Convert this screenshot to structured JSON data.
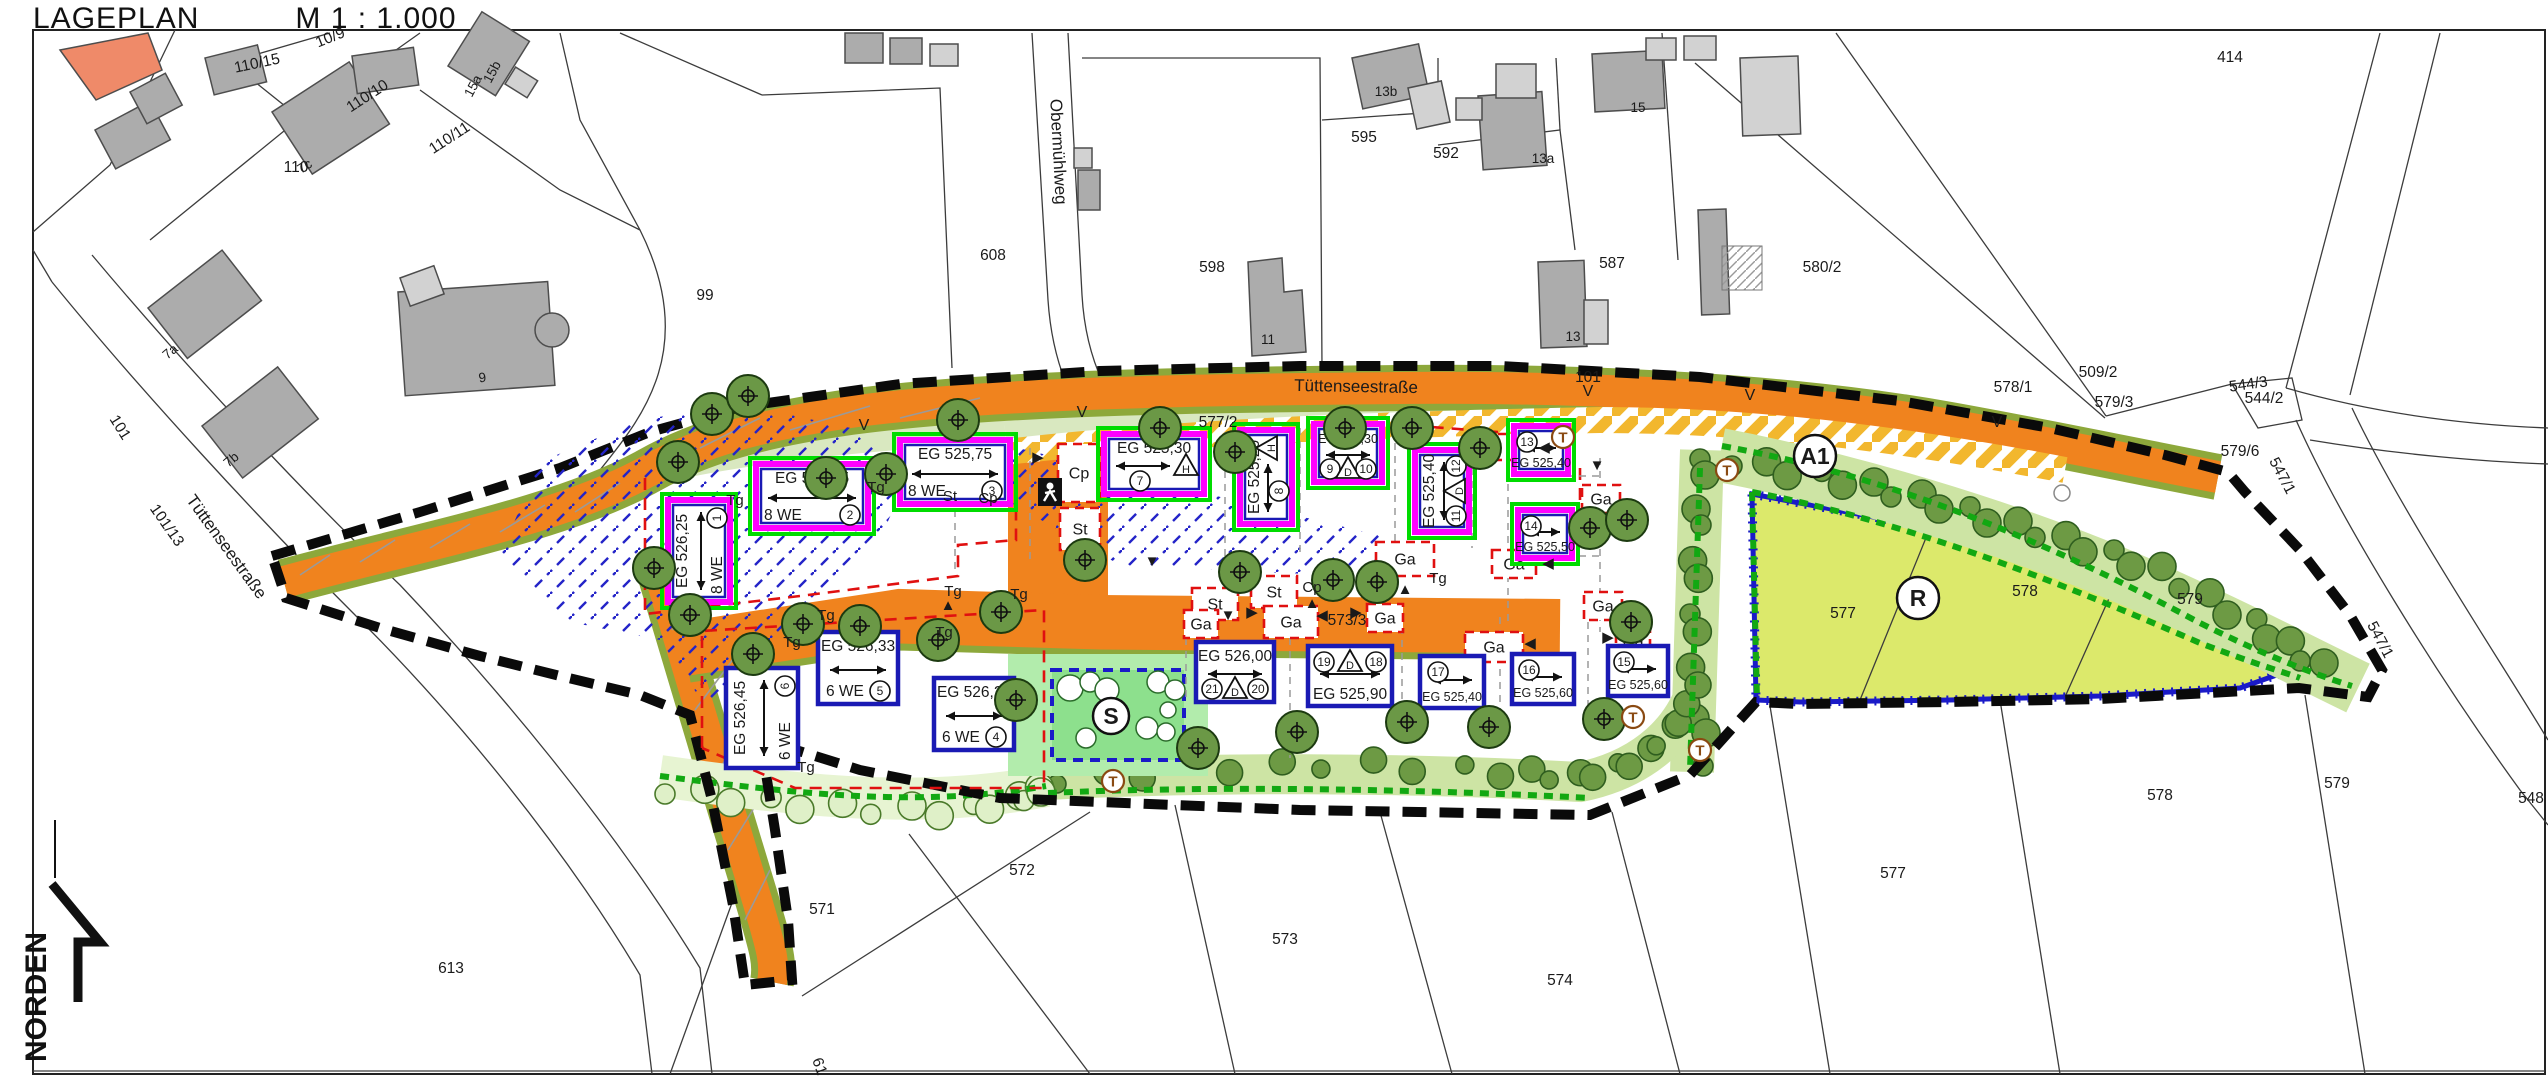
{
  "header": {
    "title": "LAGEPLAN",
    "scale": "M 1 : 1.000"
  },
  "north": {
    "label": "NORDEN"
  },
  "colors": {
    "road": "#F0831E",
    "road_edge": "#8DA83B",
    "parking_stripe": "#F2B72E",
    "field": "#DCE96B",
    "field_border": "#1A1AC8",
    "hedge_dark": "#6D9A44",
    "hedge_band": "#CDE4A4",
    "hedge_light": "#DFF0C8",
    "green_area": "#8DE08D",
    "green_light": "#B2ECAC",
    "tree": "#6B9846",
    "hatch_blue": "#2424C8",
    "boundary": "#0A0A0A",
    "baugrenze": "#E01010",
    "magenta": "#FF00FF",
    "outline_green": "#00DC00",
    "outline_blue": "#1A1AB4",
    "gray_building": "#ACACAC",
    "gray_building_light": "#D2D2D2",
    "salmon": "#EF8A69"
  },
  "street_labels": [
    {
      "text": "Obermühlweg",
      "x": 1053,
      "y": 152,
      "rot": 87,
      "size": 17
    },
    {
      "text": "Tüttenseestraße",
      "x": 222,
      "y": 550,
      "rot": 54,
      "size": 17
    },
    {
      "text": "Tüttenseestraße",
      "x": 1356,
      "y": 392,
      "rot": 1,
      "size": 17
    }
  ],
  "parcel_labels": [
    {
      "text": "10/9",
      "x": 332,
      "y": 42,
      "rot": -22
    },
    {
      "text": "110/15",
      "x": 258,
      "y": 68,
      "rot": -12
    },
    {
      "text": "110/10",
      "x": 370,
      "y": 100,
      "rot": -33
    },
    {
      "text": "110/11",
      "x": 452,
      "y": 142,
      "rot": -33
    },
    {
      "text": "110",
      "x": 296,
      "y": 172,
      "rot": 0
    },
    {
      "text": "99",
      "x": 705,
      "y": 300,
      "rot": 0
    },
    {
      "text": "608",
      "x": 993,
      "y": 260,
      "rot": 0
    },
    {
      "text": "598",
      "x": 1212,
      "y": 272,
      "rot": 0
    },
    {
      "text": "595",
      "x": 1364,
      "y": 142,
      "rot": 0
    },
    {
      "text": "592",
      "x": 1446,
      "y": 158,
      "rot": 0
    },
    {
      "text": "587",
      "x": 1612,
      "y": 268,
      "rot": 0
    },
    {
      "text": "580/2",
      "x": 1822,
      "y": 272,
      "rot": 0
    },
    {
      "text": "414",
      "x": 2230,
      "y": 62,
      "rot": 0
    },
    {
      "text": "509/2",
      "x": 2098,
      "y": 377,
      "rot": 0
    },
    {
      "text": "578/1",
      "x": 2013,
      "y": 392,
      "rot": 0
    },
    {
      "text": "579/3",
      "x": 2114,
      "y": 407,
      "rot": 0
    },
    {
      "text": "544/3",
      "x": 2249,
      "y": 389,
      "rot": -8
    },
    {
      "text": "544/2",
      "x": 2264,
      "y": 403,
      "rot": 0
    },
    {
      "text": "579/6",
      "x": 2240,
      "y": 456,
      "rot": 0
    },
    {
      "text": "547/1",
      "x": 2278,
      "y": 478,
      "rot": 62
    },
    {
      "text": "547/1",
      "x": 2376,
      "y": 642,
      "rot": 62
    },
    {
      "text": "548",
      "x": 2531,
      "y": 803,
      "rot": 0
    },
    {
      "text": "577",
      "x": 1843,
      "y": 618,
      "rot": 0
    },
    {
      "text": "578",
      "x": 2025,
      "y": 596,
      "rot": 0
    },
    {
      "text": "579",
      "x": 2190,
      "y": 604,
      "rot": 0
    },
    {
      "text": "571",
      "x": 822,
      "y": 914,
      "rot": 0
    },
    {
      "text": "572",
      "x": 1022,
      "y": 875,
      "rot": 0
    },
    {
      "text": "573",
      "x": 1285,
      "y": 944,
      "rot": 0
    },
    {
      "text": "574",
      "x": 1560,
      "y": 985,
      "rot": 0
    },
    {
      "text": "577",
      "x": 1893,
      "y": 878,
      "rot": 0
    },
    {
      "text": "578",
      "x": 2160,
      "y": 800,
      "rot": 0
    },
    {
      "text": "579",
      "x": 2337,
      "y": 788,
      "rot": 0
    },
    {
      "text": "613",
      "x": 451,
      "y": 973,
      "rot": 0
    },
    {
      "text": "101",
      "x": 116,
      "y": 430,
      "rot": 58
    },
    {
      "text": "101/13",
      "x": 163,
      "y": 528,
      "rot": 55
    },
    {
      "text": "101",
      "x": 1588,
      "y": 382,
      "rot": 0
    },
    {
      "text": "577/2",
      "x": 1218,
      "y": 427,
      "rot": 0
    },
    {
      "text": "573/3",
      "x": 1347,
      "y": 625,
      "rot": 0
    },
    {
      "text": "61",
      "x": 815,
      "y": 1068,
      "rot": 70
    }
  ],
  "building_labels": [
    {
      "text": "7c",
      "x": 307,
      "y": 170,
      "rot": -33
    },
    {
      "text": "7a",
      "x": 173,
      "y": 355,
      "rot": -40
    },
    {
      "text": "7b",
      "x": 234,
      "y": 463,
      "rot": -40
    },
    {
      "text": "9",
      "x": 483,
      "y": 382,
      "rot": -8
    },
    {
      "text": "15a",
      "x": 477,
      "y": 88,
      "rot": -62
    },
    {
      "text": "15b",
      "x": 496,
      "y": 74,
      "rot": -62
    },
    {
      "text": "13b",
      "x": 1386,
      "y": 96,
      "rot": 0
    },
    {
      "text": "13a",
      "x": 1543,
      "y": 163,
      "rot": 0
    },
    {
      "text": "15",
      "x": 1638,
      "y": 112,
      "rot": 0
    },
    {
      "text": "11",
      "x": 1268,
      "y": 344,
      "rot": 0
    },
    {
      "text": "13",
      "x": 1573,
      "y": 341,
      "rot": 0
    }
  ],
  "planned_buildings": [
    {
      "eg": "EG 526,25",
      "we": "8 WE",
      "n1": "1",
      "x": 668,
      "y": 500,
      "w": 62,
      "h": 102,
      "vert": true,
      "style": "m"
    },
    {
      "eg": "EG 526,05",
      "we": "8 WE",
      "n1": "2",
      "x": 756,
      "y": 464,
      "w": 112,
      "h": 64,
      "style": "m"
    },
    {
      "eg": "EG 525,75",
      "we": "8 WE",
      "n1": "3",
      "x": 900,
      "y": 440,
      "w": 110,
      "h": 64,
      "style": "m"
    },
    {
      "eg": "EG 526,28",
      "we": "6 WE",
      "n1": "4",
      "x": 934,
      "y": 678,
      "w": 80,
      "h": 72,
      "style": "b"
    },
    {
      "eg": "EG 526,33",
      "we": "6 WE",
      "n1": "5",
      "x": 818,
      "y": 632,
      "w": 80,
      "h": 72,
      "style": "b"
    },
    {
      "eg": "EG 526,45",
      "we": "6 WE",
      "n1": "6",
      "x": 726,
      "y": 668,
      "w": 72,
      "h": 100,
      "vert": true,
      "style": "b"
    },
    {
      "eg": "EG 525,30",
      "n1": "7",
      "roof": "H",
      "x": 1104,
      "y": 434,
      "w": 100,
      "h": 60,
      "style": "m"
    },
    {
      "eg": "EG 525,20",
      "n1": "8",
      "roof": "H",
      "x": 1240,
      "y": 430,
      "w": 52,
      "h": 94,
      "vert": true,
      "style": "m"
    },
    {
      "eg": "EG 525,30",
      "n1": "9",
      "n2": "10",
      "roof": "D",
      "x": 1314,
      "y": 424,
      "w": 68,
      "h": 58,
      "style": "m"
    },
    {
      "eg": "EG 525,40",
      "n1": "11",
      "n2": "12",
      "roof": "D",
      "x": 1415,
      "y": 450,
      "w": 54,
      "h": 82,
      "vert": true,
      "style": "m"
    },
    {
      "eg": "EG 525,40",
      "n1": "13",
      "x": 1514,
      "y": 426,
      "w": 54,
      "h": 48,
      "flip": true,
      "style": "m"
    },
    {
      "eg": "EG 525,50",
      "n1": "14",
      "x": 1518,
      "y": 510,
      "w": 54,
      "h": 48,
      "flip": true,
      "style": "m"
    },
    {
      "eg": "EG 525,60",
      "n1": "15",
      "x": 1608,
      "y": 646,
      "w": 60,
      "h": 50,
      "flip": true,
      "style": "b"
    },
    {
      "eg": "EG 525,60",
      "n1": "16",
      "x": 1512,
      "y": 654,
      "w": 62,
      "h": 50,
      "flip": true,
      "style": "b"
    },
    {
      "eg": "EG 525,40",
      "n1": "17",
      "x": 1420,
      "y": 656,
      "w": 64,
      "h": 52,
      "flip": true,
      "style": "b"
    },
    {
      "eg": "EG 525,90",
      "n1": "19",
      "n2": "18",
      "roof": "D",
      "x": 1308,
      "y": 646,
      "w": 84,
      "h": 60,
      "flip": true,
      "style": "b"
    },
    {
      "eg": "EG 526,00",
      "n1": "21",
      "n2": "20",
      "roof": "D",
      "x": 1196,
      "y": 642,
      "w": 78,
      "h": 60,
      "style": "b"
    }
  ],
  "parking_boxes": [
    {
      "label": "Cp",
      "x": 1058,
      "y": 444,
      "w": 42,
      "h": 58
    },
    {
      "label": "St",
      "x": 1060,
      "y": 508,
      "w": 40,
      "h": 42
    },
    {
      "label": "St",
      "x": 1192,
      "y": 588,
      "w": 46,
      "h": 32
    },
    {
      "label": "St",
      "x": 1251,
      "y": 576,
      "w": 46,
      "h": 32
    },
    {
      "label": "Ga",
      "x": 1376,
      "y": 542,
      "w": 58,
      "h": 34
    },
    {
      "label": "",
      "x": 1498,
      "y": 434,
      "w": 34,
      "h": 26
    },
    {
      "label": "Ga",
      "x": 1492,
      "y": 550,
      "w": 44,
      "h": 28
    },
    {
      "label": "Ga",
      "x": 1582,
      "y": 485,
      "w": 38,
      "h": 28
    },
    {
      "label": "Ga",
      "x": 1584,
      "y": 592,
      "w": 38,
      "h": 28
    },
    {
      "label": "Ga",
      "x": 1184,
      "y": 610,
      "w": 34,
      "h": 28
    },
    {
      "label": "Ga",
      "x": 1264,
      "y": 606,
      "w": 54,
      "h": 32
    },
    {
      "label": "Ga",
      "x": 1367,
      "y": 604,
      "w": 36,
      "h": 28
    },
    {
      "label": "Ga",
      "x": 1465,
      "y": 632,
      "w": 58,
      "h": 30
    },
    {
      "label": "Ga",
      "x": 1616,
      "y": 628,
      "w": 34,
      "h": 26
    }
  ],
  "small_labels": [
    {
      "text": "Tg",
      "x": 876,
      "y": 492
    },
    {
      "text": "Tg",
      "x": 735,
      "y": 505
    },
    {
      "text": "Tg",
      "x": 826,
      "y": 620
    },
    {
      "text": "Tg",
      "x": 1019,
      "y": 599
    },
    {
      "text": "Tg",
      "x": 953,
      "y": 596
    },
    {
      "text": "Tg",
      "x": 792,
      "y": 647
    },
    {
      "text": "Tg",
      "x": 944,
      "y": 637
    },
    {
      "text": "Tg",
      "x": 806,
      "y": 772
    },
    {
      "text": "Tg",
      "x": 1438,
      "y": 583
    },
    {
      "text": "St",
      "x": 950,
      "y": 501
    },
    {
      "text": "Cp",
      "x": 988,
      "y": 503
    },
    {
      "text": "Cp",
      "x": 1312,
      "y": 592
    }
  ],
  "arrows": [
    {
      "ch": "▲",
      "x": 948,
      "y": 610
    },
    {
      "ch": "▼",
      "x": 1152,
      "y": 566
    },
    {
      "ch": "▲",
      "x": 1405,
      "y": 594
    },
    {
      "ch": "▲",
      "x": 1312,
      "y": 608
    },
    {
      "ch": "▼",
      "x": 1597,
      "y": 470
    },
    {
      "ch": "▼",
      "x": 1228,
      "y": 620
    },
    {
      "ch": "▶",
      "x": 1252,
      "y": 617
    },
    {
      "ch": "◀",
      "x": 1322,
      "y": 620
    },
    {
      "ch": "▶",
      "x": 1356,
      "y": 617
    },
    {
      "ch": "◀",
      "x": 1530,
      "y": 648
    },
    {
      "ch": "▶",
      "x": 1608,
      "y": 642
    },
    {
      "ch": "◀",
      "x": 1544,
      "y": 452
    },
    {
      "ch": "◀",
      "x": 1548,
      "y": 568
    },
    {
      "ch": "▶",
      "x": 1038,
      "y": 462
    }
  ],
  "v_marks": {
    "text": "V",
    "points": [
      [
        864,
        430
      ],
      [
        1082,
        417
      ],
      [
        1588,
        396
      ],
      [
        1750,
        400
      ],
      [
        1997,
        427
      ]
    ]
  },
  "circle_markers": [
    {
      "text": "A1",
      "x": 1815,
      "y": 456,
      "r": 21
    },
    {
      "text": "R",
      "x": 1918,
      "y": 598,
      "r": 21
    },
    {
      "text": "S",
      "x": 1111,
      "y": 716,
      "r": 18
    }
  ],
  "t_markers": {
    "text": "T",
    "points": [
      [
        1727,
        470
      ],
      [
        1633,
        717
      ],
      [
        1700,
        750
      ],
      [
        1113,
        781
      ],
      [
        1563,
        437
      ]
    ]
  },
  "trees": [
    [
      654,
      568
    ],
    [
      678,
      462
    ],
    [
      712,
      414
    ],
    [
      748,
      396
    ],
    [
      826,
      478
    ],
    [
      886,
      474
    ],
    [
      958,
      420
    ],
    [
      753,
      654
    ],
    [
      803,
      624
    ],
    [
      860,
      626
    ],
    [
      938,
      640
    ],
    [
      1001,
      612
    ],
    [
      1085,
      560
    ],
    [
      1160,
      428
    ],
    [
      1235,
      452
    ],
    [
      1345,
      428
    ],
    [
      1412,
      428
    ],
    [
      1480,
      448
    ],
    [
      1590,
      528
    ],
    [
      1627,
      520
    ],
    [
      1631,
      622
    ],
    [
      1240,
      572
    ],
    [
      1333,
      580
    ],
    [
      1377,
      582
    ],
    [
      1198,
      748
    ],
    [
      1297,
      732
    ],
    [
      1407,
      722
    ],
    [
      1489,
      727
    ],
    [
      1604,
      719
    ],
    [
      690,
      615
    ],
    [
      1016,
      700
    ]
  ]
}
